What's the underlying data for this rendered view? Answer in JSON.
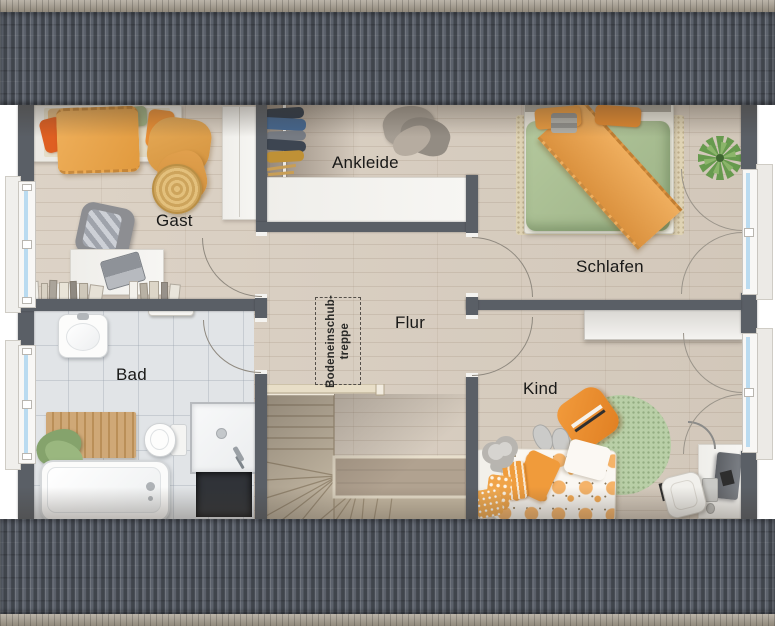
{
  "plan": {
    "rooms": {
      "gast": {
        "label": "Gast"
      },
      "ankleide": {
        "label": "Ankleide"
      },
      "schlafen": {
        "label": "Schlafen"
      },
      "flur": {
        "label": "Flur"
      },
      "bad": {
        "label": "Bad"
      },
      "kind": {
        "label": "Kind"
      }
    },
    "attic_hatch": {
      "line1": "Bodeneinschub-",
      "line2": "treppe"
    },
    "colors": {
      "roof": "#565c66",
      "ridge": "#a49b8c",
      "wall": "#5a5f66",
      "wood_floor": "#d9cec0",
      "tile_floor": "#e1e4e7",
      "stair_wood": "#cdc1ac",
      "accent_orange": "#e8973e",
      "duvet_green": "#abc095",
      "rug_green": "#b9cfa7",
      "rug_beige": "#dfd3b4",
      "glazing_blue": "#badbf0"
    }
  }
}
